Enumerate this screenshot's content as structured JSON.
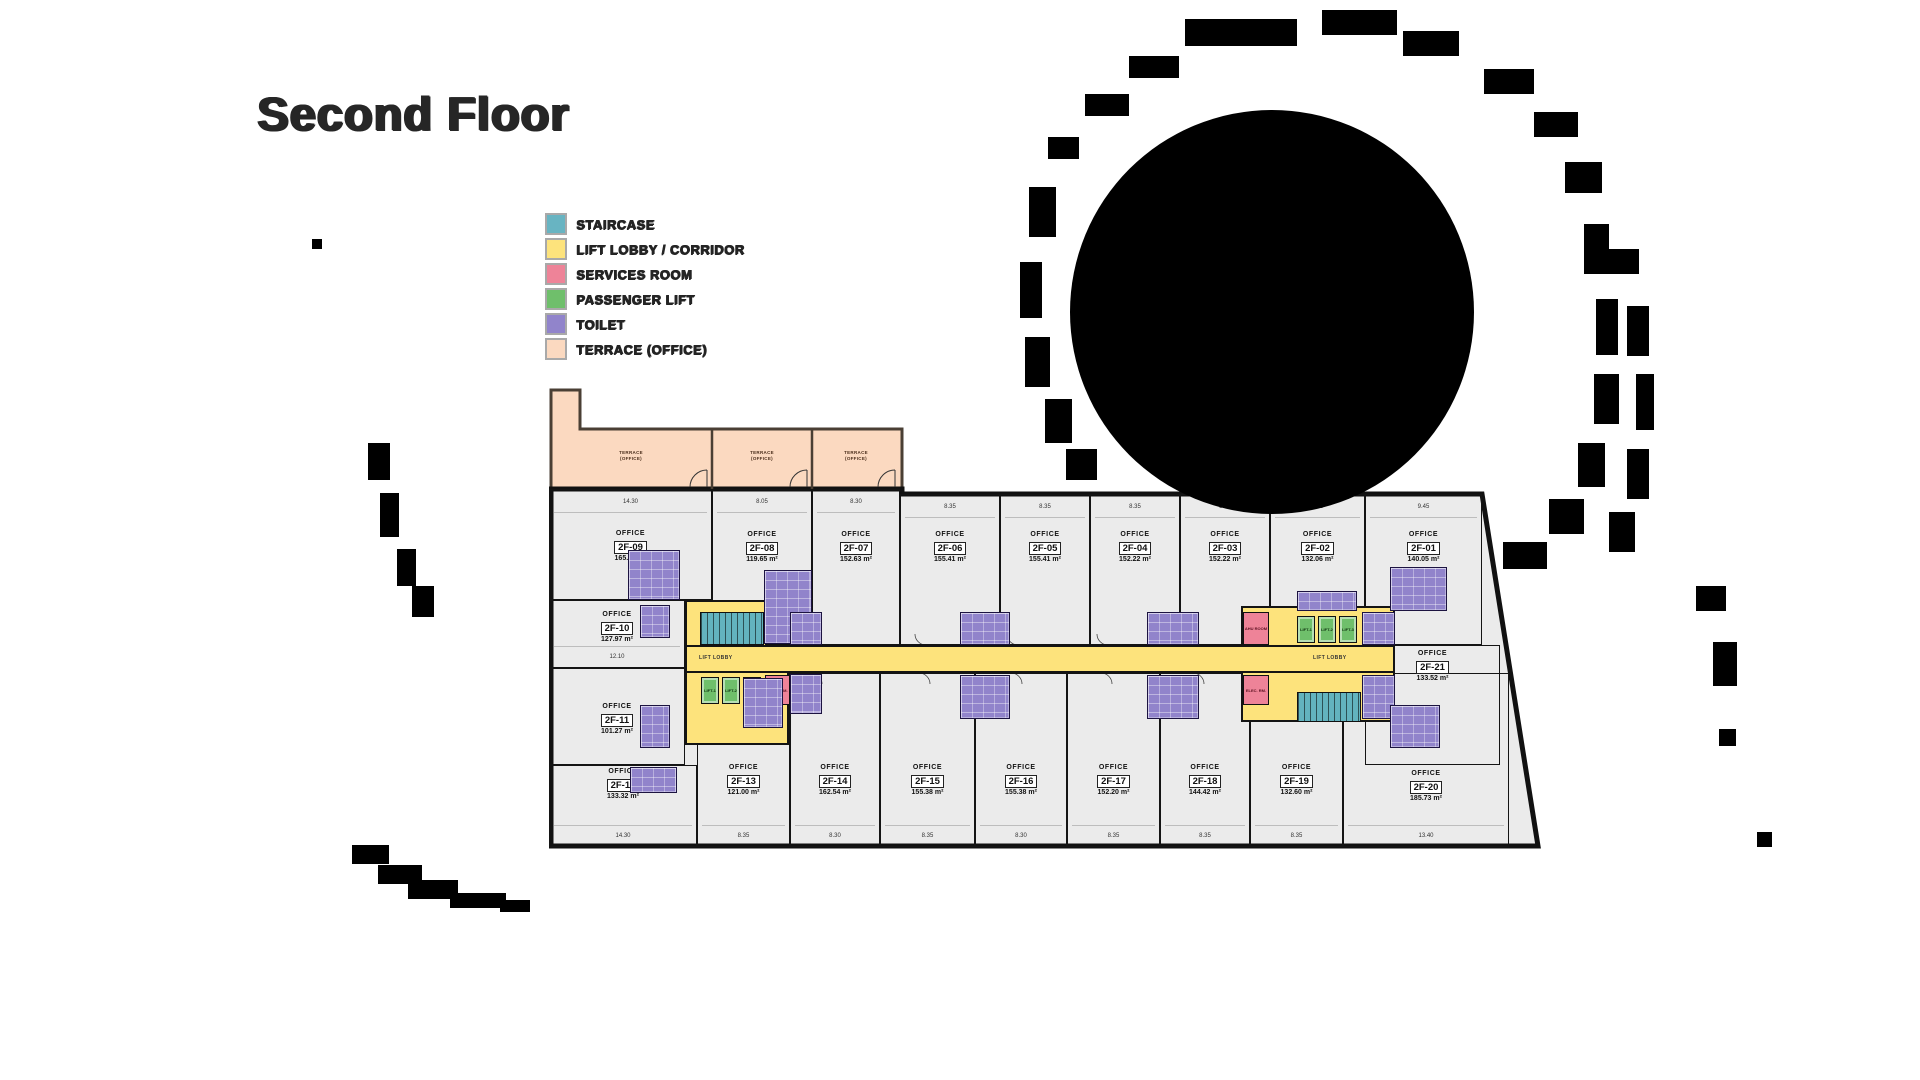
{
  "title": "Second Floor",
  "labels": {
    "office": "OFFICE",
    "lift_lobby": "LIFT LOBBY"
  },
  "legend": [
    {
      "label": "STAIRCASE",
      "color": "#68b4c2"
    },
    {
      "label": "LIFT LOBBY / CORRIDOR",
      "color": "#fde37c"
    },
    {
      "label": "SERVICES ROOM",
      "color": "#ee8398"
    },
    {
      "label": "PASSENGER LIFT",
      "color": "#6fbf6b"
    },
    {
      "label": "TOILET",
      "color": "#9184cb"
    },
    {
      "label": "TERRACE (OFFICE)",
      "color": "#fbd9c0"
    }
  ],
  "terrace": {
    "line1": "TERRACE",
    "line2": "(OFFICE)"
  },
  "cores": {
    "left": {
      "lobby": "LIFT LOBBY",
      "duct": "E. DUCT",
      "elec": "ELEC. RM.",
      "lifts": [
        "LIFT-1",
        "LIFT-2",
        "LIFT-3"
      ]
    },
    "right": {
      "lobby": "LIFT LOBBY",
      "ahu": "AHU ROOM",
      "elec": "ELEC. RM.",
      "lifts": [
        "LIFT-1",
        "LIFT-2",
        "LIFT-3"
      ]
    }
  },
  "units": [
    {
      "id": "2F-01",
      "area": "140.05 m²",
      "dim": "9.45"
    },
    {
      "id": "2F-02",
      "area": "132.06 m²",
      "dim": "8.35"
    },
    {
      "id": "2F-03",
      "area": "152.22 m²",
      "dim": "8.35"
    },
    {
      "id": "2F-04",
      "area": "152.22 m²",
      "dim": "8.35"
    },
    {
      "id": "2F-05",
      "area": "155.41 m²",
      "dim": "8.35"
    },
    {
      "id": "2F-06",
      "area": "155.41 m²",
      "dim": "8.35"
    },
    {
      "id": "2F-07",
      "area": "152.63 m²",
      "dim": "8.30"
    },
    {
      "id": "2F-08",
      "area": "119.65 m²",
      "dim": "8.05"
    },
    {
      "id": "2F-09",
      "area": "165.07 m²",
      "dim": "14.30"
    },
    {
      "id": "2F-10",
      "area": "127.97 m²",
      "dim": "12.10"
    },
    {
      "id": "2F-11",
      "area": "101.27 m²",
      "dim": ""
    },
    {
      "id": "2F-12",
      "area": "133.32 m²",
      "dim": "14.30"
    },
    {
      "id": "2F-13",
      "area": "121.00 m²",
      "dim": "8.35"
    },
    {
      "id": "2F-14",
      "area": "162.54 m²",
      "dim": "8.30"
    },
    {
      "id": "2F-15",
      "area": "155.38 m²",
      "dim": "8.35"
    },
    {
      "id": "2F-16",
      "area": "155.38 m²",
      "dim": "8.30"
    },
    {
      "id": "2F-17",
      "area": "152.20 m²",
      "dim": "8.35"
    },
    {
      "id": "2F-18",
      "area": "144.42 m²",
      "dim": "8.35"
    },
    {
      "id": "2F-19",
      "area": "132.60 m²",
      "dim": "8.35"
    },
    {
      "id": "2F-20",
      "area": "185.73 m²",
      "dim": "13.40"
    },
    {
      "id": "2F-21",
      "area": "133.52 m²",
      "dim": ""
    }
  ]
}
